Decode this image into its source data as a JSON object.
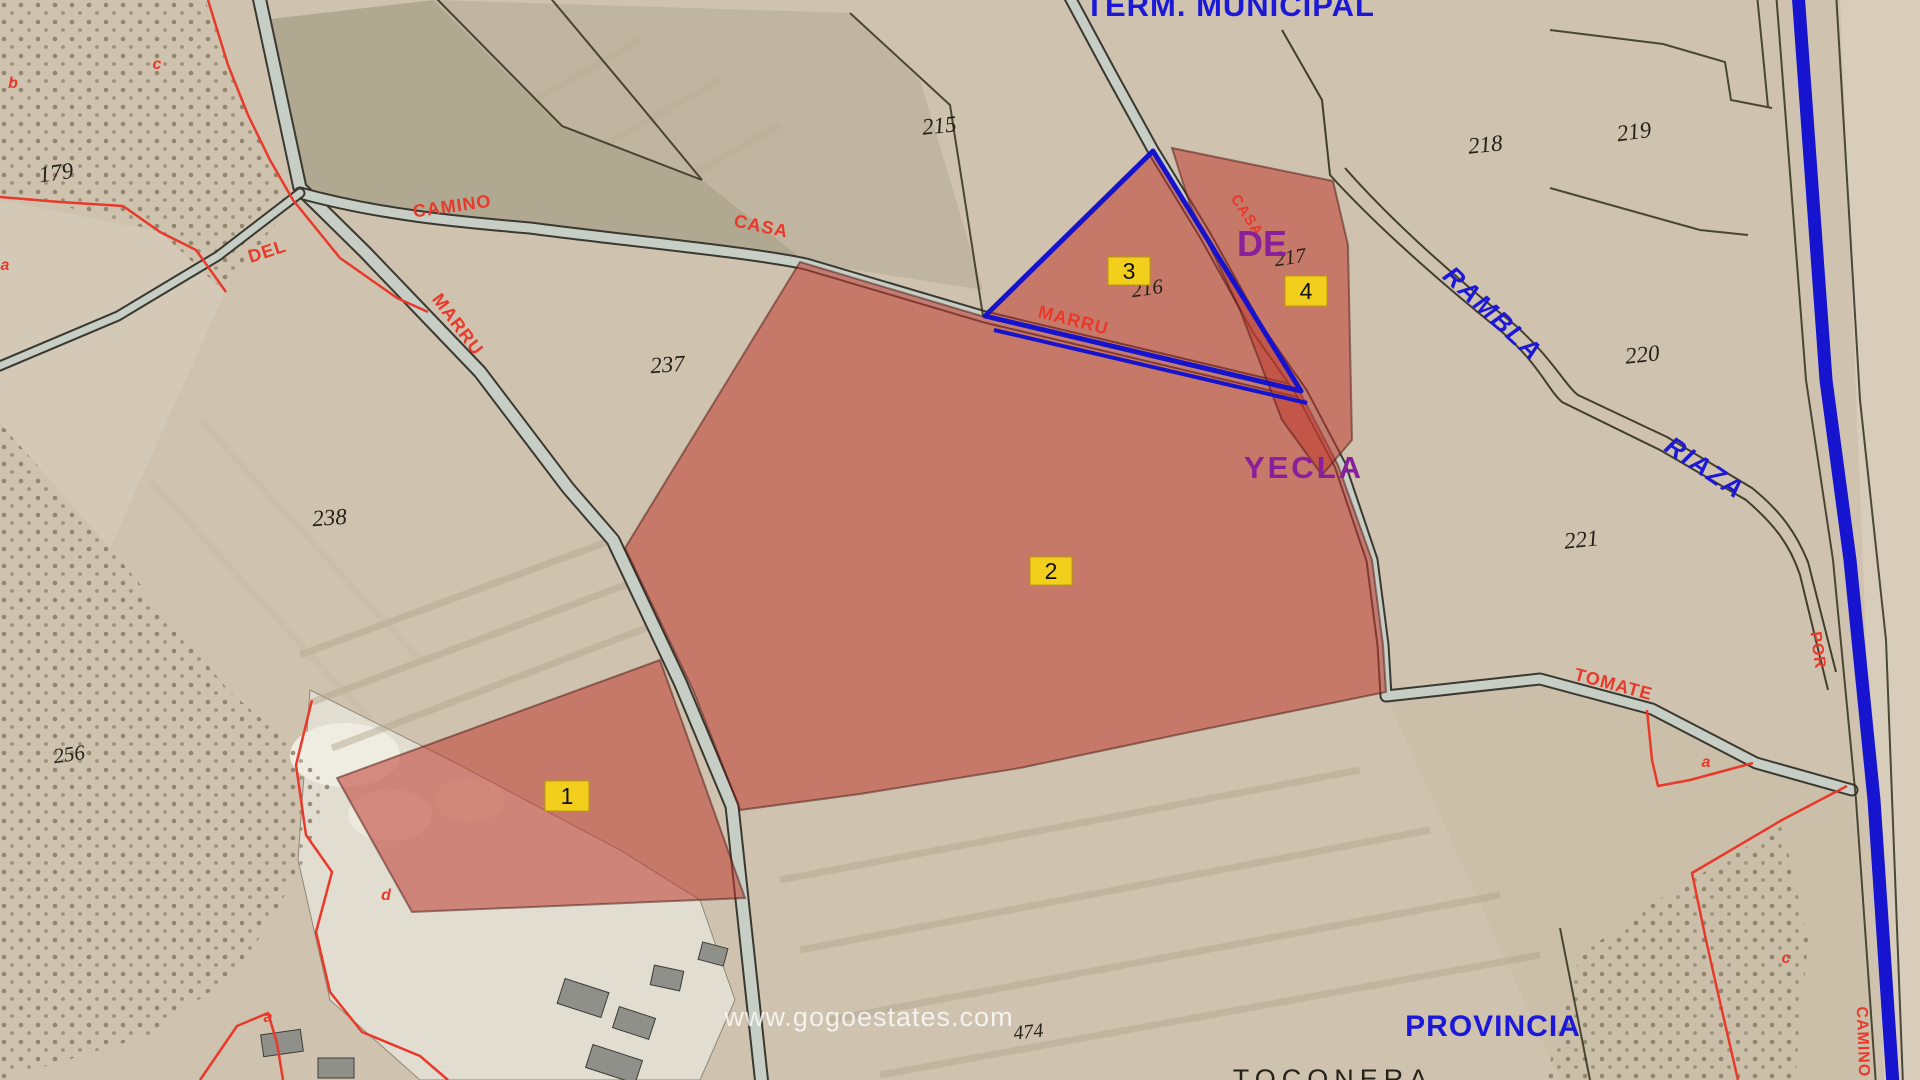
{
  "map": {
    "watermark": "www.gogoestates.com",
    "admin_labels": {
      "term_municipal": "TERM. MUNICIPAL",
      "de": "DE",
      "yecla": "YECLA",
      "provincia": "PROVINCIA",
      "toconera": "TOCONERA"
    },
    "hydro_labels": {
      "rambla": "RAMBLA",
      "riaza": "RIAZA"
    },
    "road_labels": {
      "camino": "CAMINO",
      "del": "DEL",
      "marru": "MARRU",
      "casa": "CASA",
      "marru2": "MARRU",
      "casa2": "CASA",
      "tomate": "TOMATE",
      "por": "POR",
      "camino2": "CAMINO"
    },
    "parcel_numbers": {
      "p179": "179",
      "p215": "215",
      "p216": "216",
      "p217": "217",
      "p218": "218",
      "p219": "219",
      "p220": "220",
      "p221": "221",
      "p237": "237",
      "p238": "238",
      "p256": "256",
      "p474": "474"
    },
    "subparcel_letters": {
      "b": "b",
      "c": "c",
      "a": "a",
      "d": "d",
      "a2": "a",
      "a3": "a",
      "c2": "c"
    },
    "markers": {
      "m1": "1",
      "m2": "2",
      "m3": "3",
      "m4": "4"
    },
    "colors": {
      "highlight_red": "#c03a2f",
      "marker_yellow": "#f2cf1d",
      "admin_blue": "#1c18d8",
      "municipality_purple": "#8a1f9c",
      "cadastral_red": "#e8392a",
      "parcel_boundary_blue": "#1712cb"
    }
  }
}
